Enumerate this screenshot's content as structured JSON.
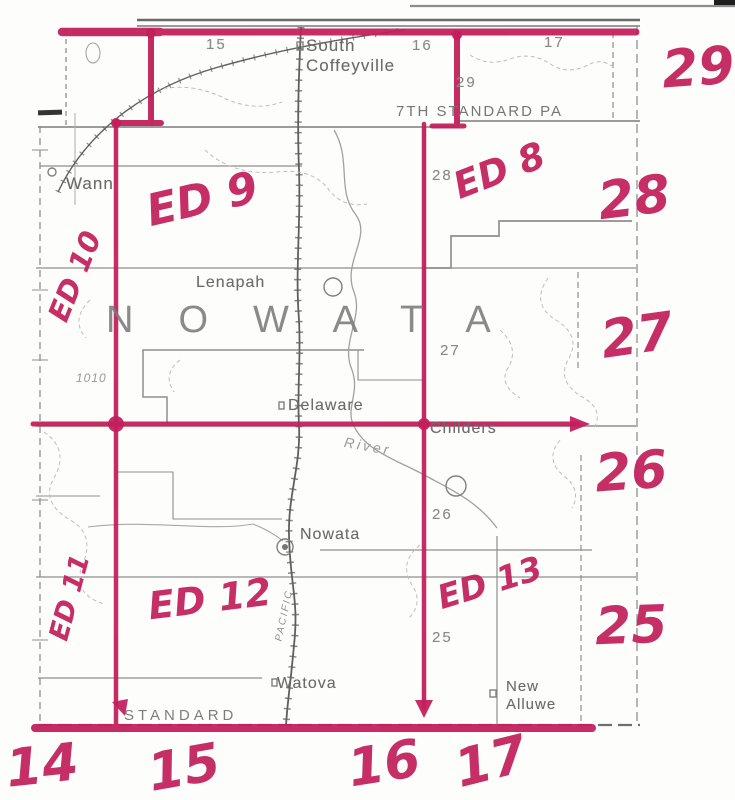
{
  "map": {
    "county_name": "NOWATA",
    "standard_parallel_label": "7TH STANDARD PA",
    "standard_label": "STANDARD",
    "railroad_label": "PACIFIC",
    "river_label": "River",
    "elevation_label": "1010",
    "towns": {
      "south_coffeyville": "South Coffeyville",
      "wann": "Wann",
      "lenapah": "Lenapah",
      "delaware": "Delaware",
      "childers": "Childers",
      "nowata": "Nowata",
      "watova": "Watova",
      "new_alluwe": "New Alluwe"
    },
    "printed_numbers": {
      "top_15": "15",
      "top_16": "16",
      "top_17": "17",
      "range_29": "29",
      "range_28": "28",
      "range_27": "27",
      "range_26": "26",
      "range_25": "25"
    }
  },
  "annotations": {
    "ink_color": "#c21f5b",
    "districts": {
      "ed8": "ED 8",
      "ed9": "ED 9",
      "ed10": "ED 10",
      "ed11": "ED 11",
      "ed12": "ED 12",
      "ed13": "ED 13"
    },
    "right_margin": [
      "29",
      "28",
      "27",
      "26",
      "25"
    ],
    "bottom_margin": [
      "14",
      "15",
      "16",
      "17"
    ]
  }
}
